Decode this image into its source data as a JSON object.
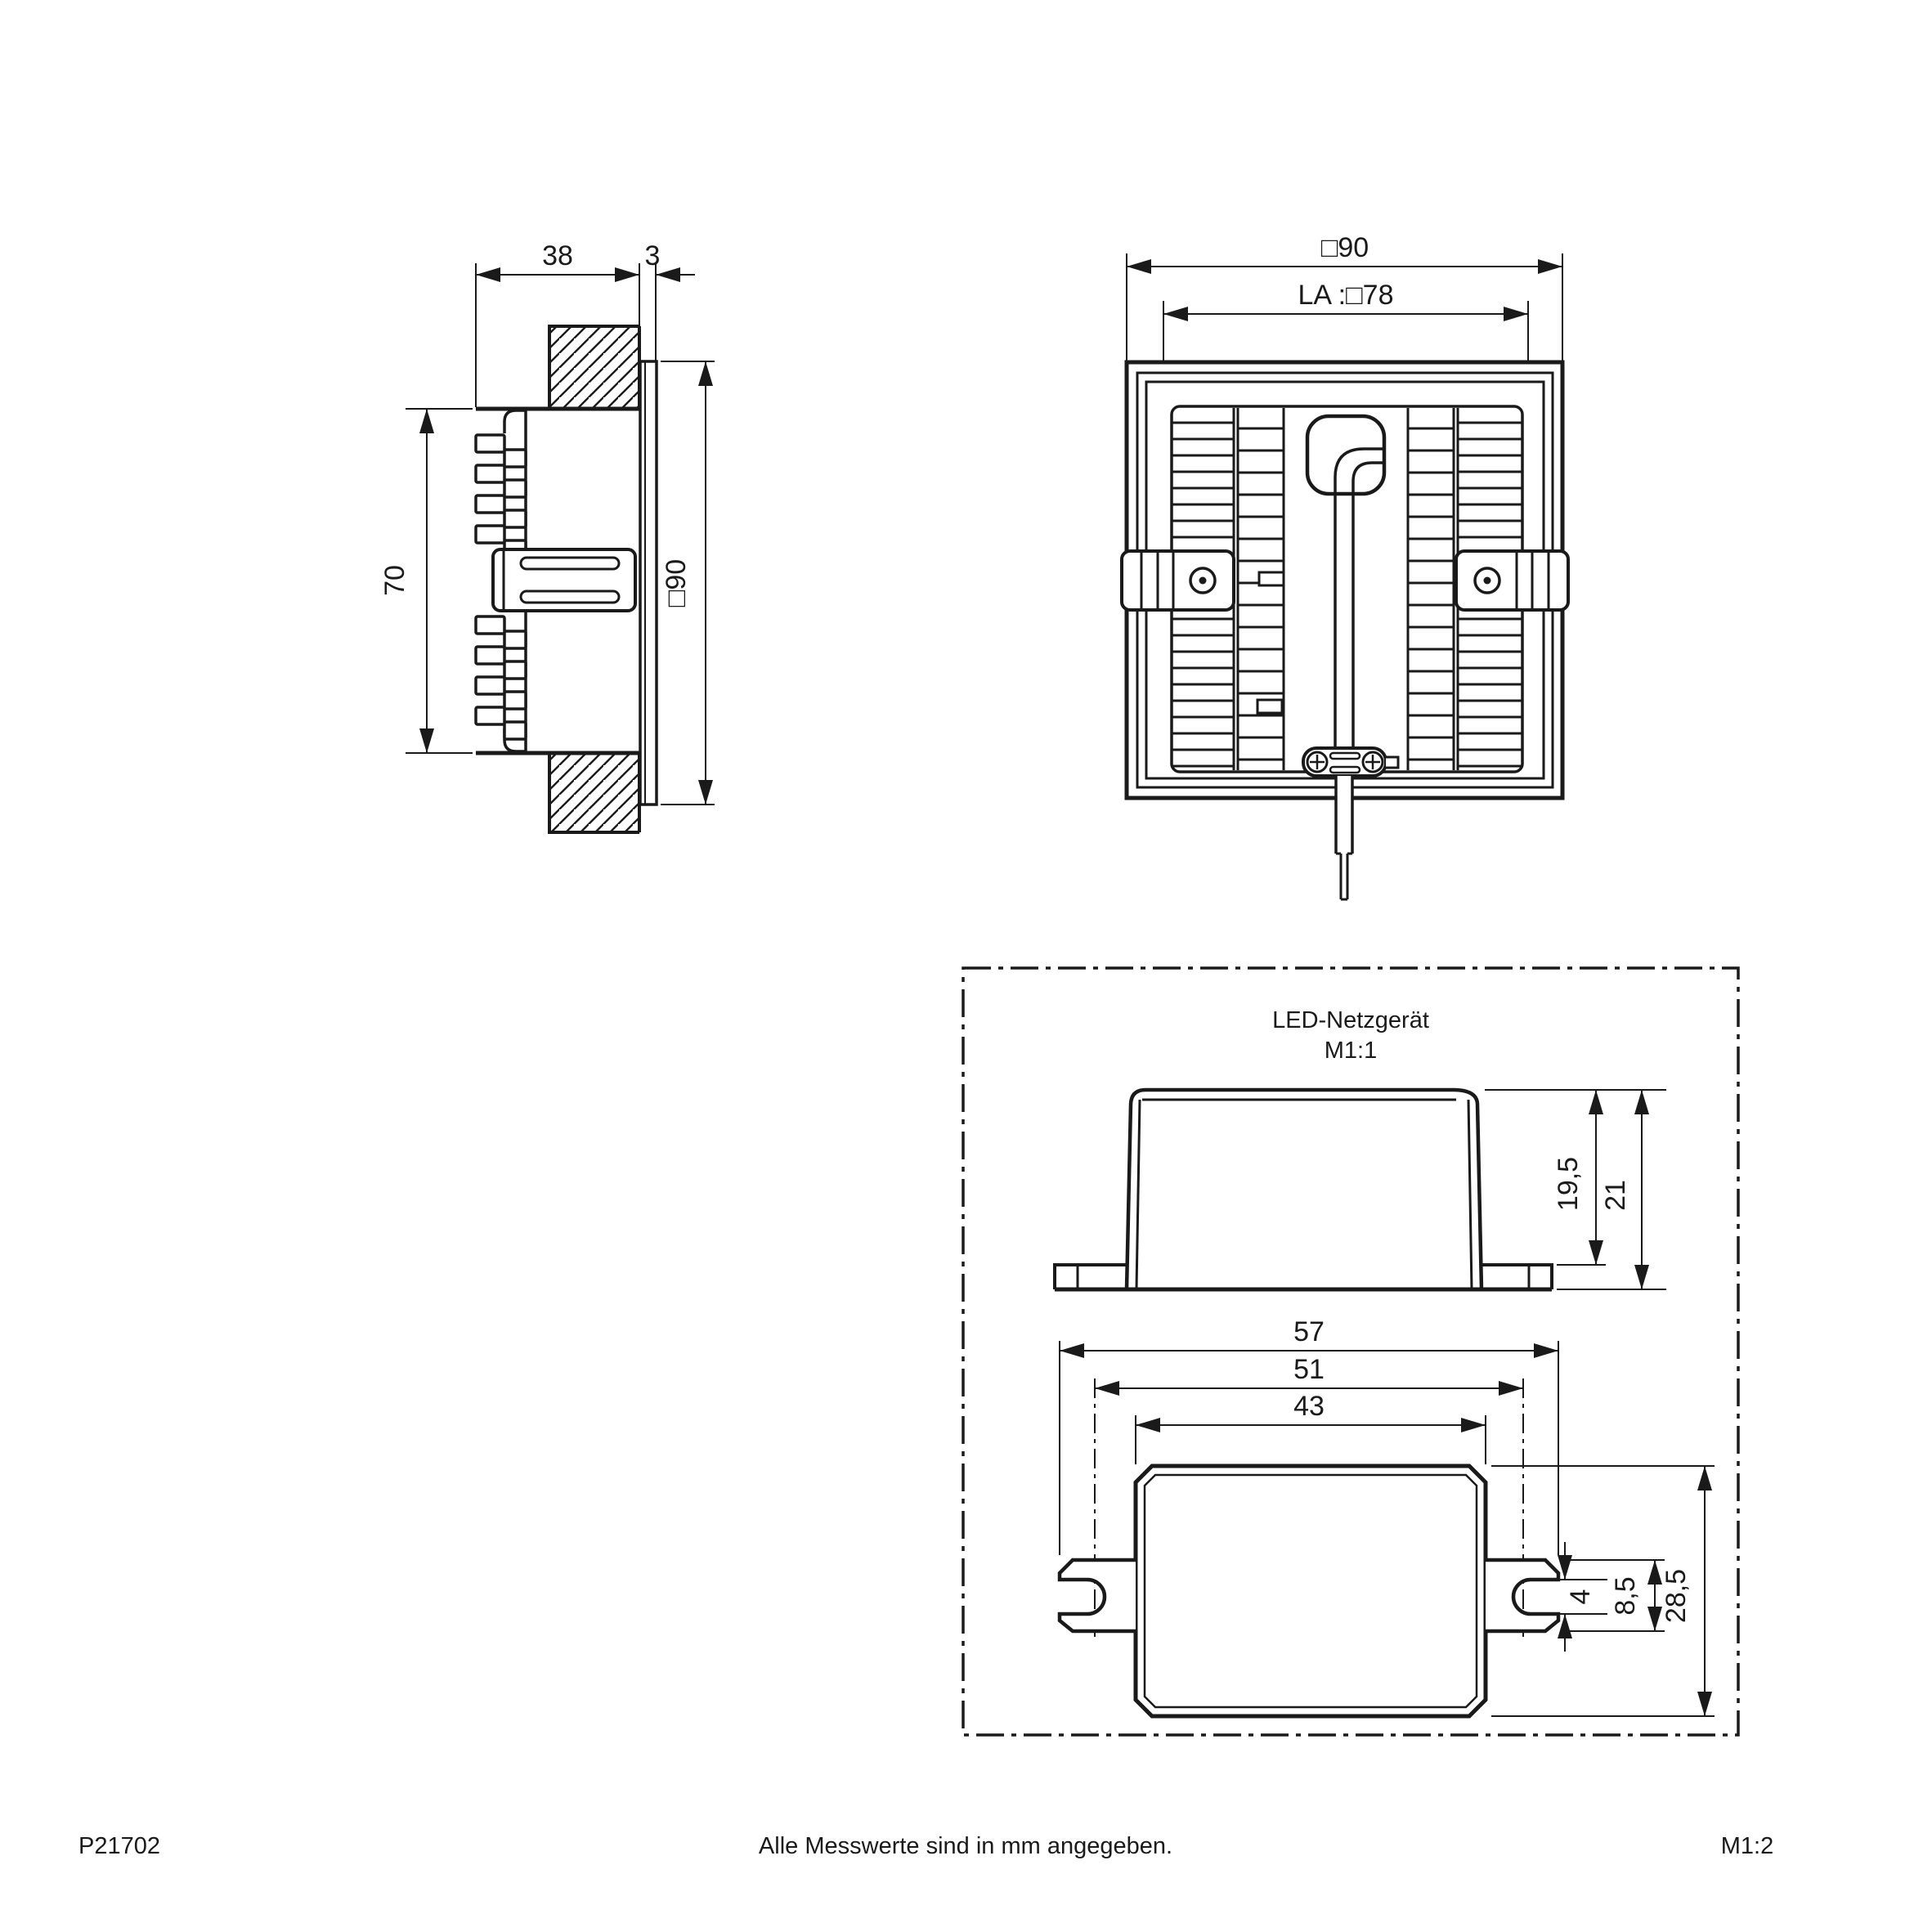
{
  "side_view": {
    "label_depth": "38",
    "label_bezel": "3",
    "label_height": "70",
    "label_front": "□90"
  },
  "back_view": {
    "label_outer": "□90",
    "label_cutout": "LA :□78"
  },
  "psu": {
    "title": "LED-Netzgerät",
    "scale": "M1:1",
    "label_body_height": "19,5",
    "label_total_height": "21",
    "label_total_width": "57",
    "label_slot_spacing": "51",
    "label_body_width": "43",
    "label_notch": "4",
    "label_tab_height": "8,5",
    "label_depth": "28,5"
  },
  "footer": {
    "part_number": "P21702",
    "note": "Alle Messwerte sind in mm angegeben.",
    "scale": "M1:2"
  }
}
